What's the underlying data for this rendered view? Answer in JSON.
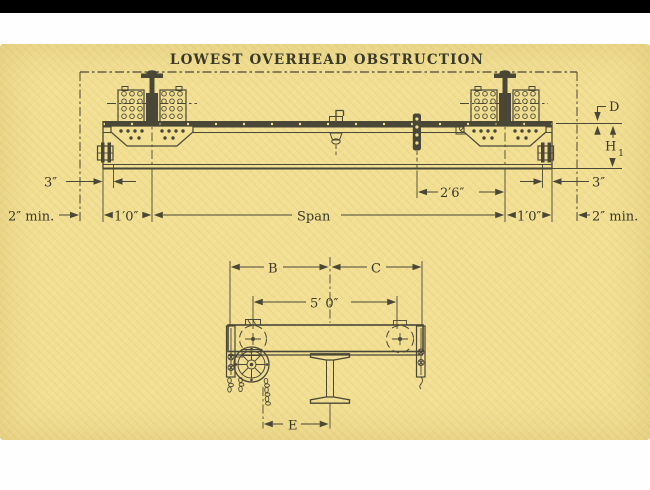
{
  "title": "LOWEST OVERHEAD OBSTRUCTION",
  "top_view": {
    "dim_3in_left": "3″",
    "dim_2min_left": "2″ min.",
    "dim_1ft_left": "1′0″",
    "dim_span": "Span",
    "dim_2ft6": "2′6″",
    "dim_1ft_right": "1′0″",
    "dim_2min_right": "2″ min.",
    "dim_3in_right": "3″",
    "dim_d": "D",
    "dim_h": "H",
    "dim_h_sub": "1"
  },
  "bottom_view": {
    "dim_b": "B",
    "dim_c": "C",
    "dim_5ft": "5′ 0″",
    "dim_e": "E"
  },
  "colors": {
    "paper": "#f2df92",
    "ink": "#4a4736",
    "text": "#3a3827",
    "top_bar": "#000000",
    "page_bg": "#fefefe"
  }
}
